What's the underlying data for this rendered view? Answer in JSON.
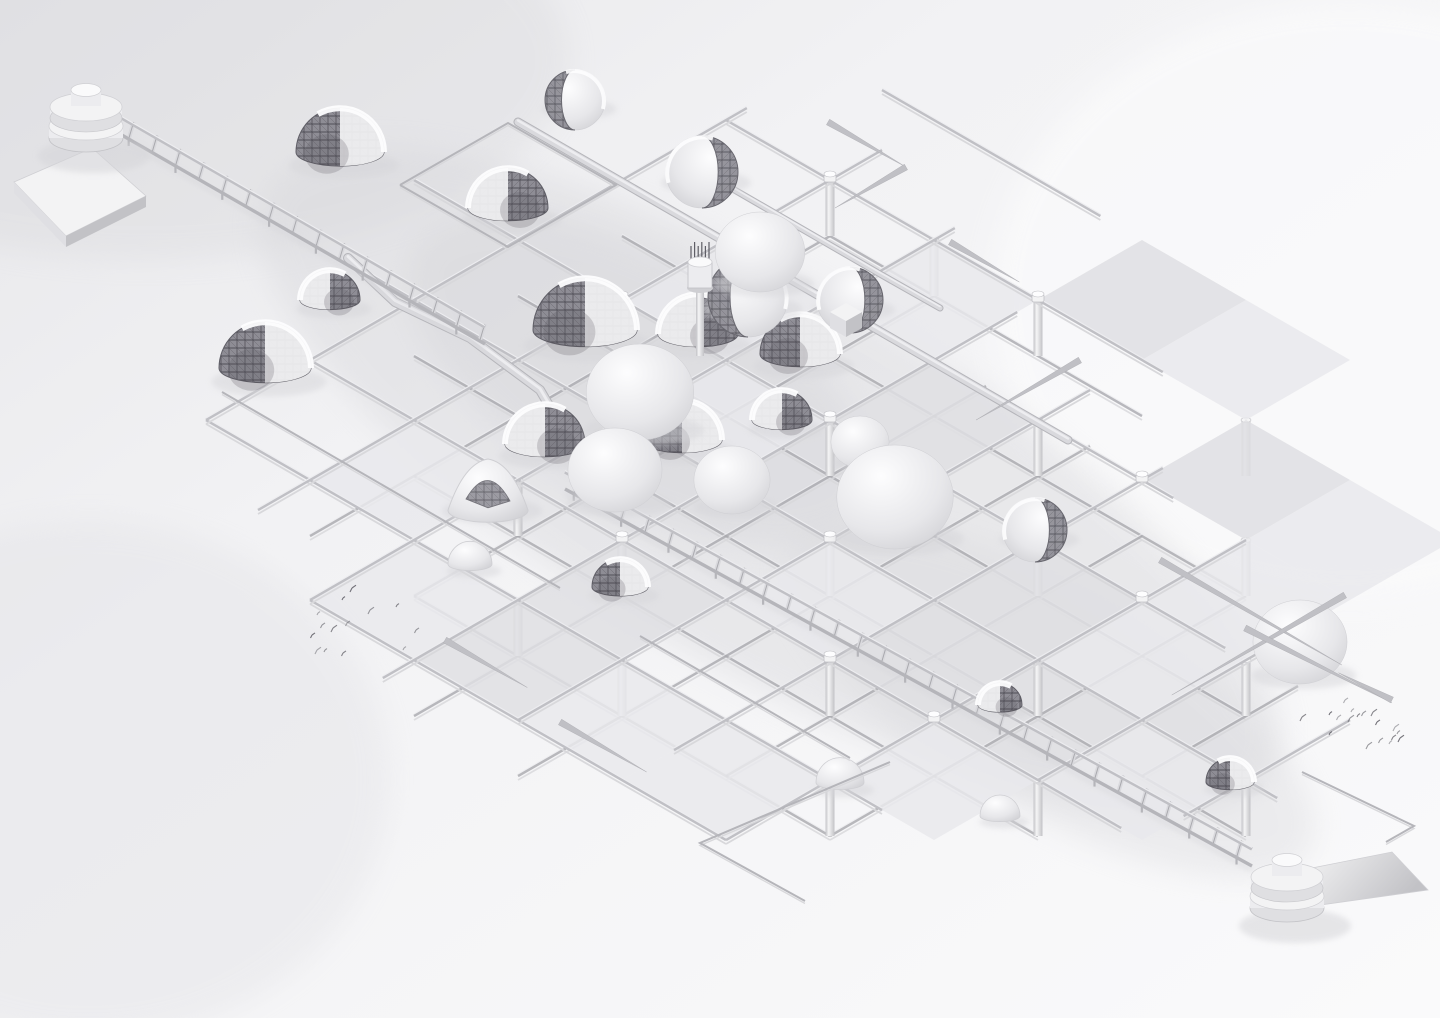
{
  "scene": {
    "title": "Monochrome isometric render of a modular space-frame structure with geodesic domes, conveyor trusses and spool terminals",
    "bg_base": "#f2f2f4",
    "bg_shade": "#e7e7ea",
    "bg_light": "#fafafb"
  },
  "palette": {
    "beam": "#c0c0c5",
    "beam_hi": "#ededf0",
    "beam_lo": "#d8d8db",
    "beam_dark": "#a9a9ae",
    "pipe": "#d9d9dd",
    "pipe_edge": "#b5b5ba",
    "panel": "#e9e9ec",
    "panel_dark": "#dfdfe3",
    "post_light": "#f5f5f6",
    "post_dark": "#c2c2c6",
    "mesh_base": "#8e8d95",
    "mesh_line": "#504f57",
    "mesh_edge": "#5f5e66",
    "shell_white": "#f3f3f4",
    "sphere_hi": "#fdfdfe",
    "sphere_mid": "#e7e7ea",
    "sphere_edge": "#cfcfd3",
    "shadow": "#d5d5d9",
    "speck": "#55545c",
    "spool_top": "#fafafb",
    "spool_body": "#ececef",
    "spool_rim": "#dfdfe2"
  },
  "grid": {
    "o": [
      830,
      60
    ],
    "u": [
      104,
      60
    ],
    "v": [
      -104,
      60
    ],
    "drop": 56,
    "railsU": [
      [
        0,
        0.5,
        2.6,
        0
      ],
      [
        1,
        0,
        4.2,
        0
      ],
      [
        2,
        -1,
        5.3,
        0
      ],
      [
        3,
        -1,
        6.8,
        0
      ],
      [
        4,
        -0.5,
        8.3,
        0
      ],
      [
        5,
        0,
        7.8,
        0
      ],
      [
        6,
        0,
        6.5,
        0
      ],
      [
        7,
        2,
        6,
        0
      ],
      [
        1,
        1,
        4,
        1
      ],
      [
        2,
        0,
        6,
        1
      ],
      [
        3,
        0,
        7,
        1
      ],
      [
        4,
        0,
        8,
        1
      ],
      [
        5,
        1,
        7,
        1
      ],
      [
        6,
        2,
        6,
        1
      ]
    ],
    "railsV": [
      [
        0,
        0.8,
        6,
        0
      ],
      [
        1,
        0.5,
        6.5,
        0
      ],
      [
        2,
        0.8,
        7,
        0
      ],
      [
        3,
        1.2,
        7.3,
        0
      ],
      [
        4,
        1.5,
        7,
        0
      ],
      [
        5,
        1.8,
        6.5,
        0
      ],
      [
        6,
        2,
        7,
        0
      ],
      [
        7,
        2.4,
        5,
        0
      ],
      [
        8,
        3,
        4.6,
        0
      ],
      [
        1,
        1,
        6,
        1
      ],
      [
        2,
        1,
        6,
        1
      ],
      [
        3,
        1.5,
        7,
        1
      ],
      [
        4,
        1.5,
        7,
        1
      ],
      [
        5,
        2,
        6,
        1
      ],
      [
        6,
        2,
        6,
        1
      ],
      [
        7,
        2.5,
        4,
        1
      ]
    ],
    "panels": [
      [
        3,
        0
      ],
      [
        4,
        0
      ],
      [
        2,
        1
      ],
      [
        5,
        1
      ],
      [
        6,
        1
      ],
      [
        1,
        2
      ],
      [
        3,
        2
      ],
      [
        6,
        2
      ],
      [
        2,
        3
      ],
      [
        5,
        3
      ],
      [
        6,
        3
      ],
      [
        4,
        4
      ],
      [
        5,
        4
      ],
      [
        7,
        4
      ],
      [
        1,
        5
      ],
      [
        3,
        5
      ],
      [
        6,
        5
      ],
      [
        2,
        6
      ],
      [
        3,
        6
      ],
      [
        4,
        6
      ],
      [
        5,
        6
      ]
    ],
    "posts": [
      [
        1,
        1
      ],
      [
        2,
        1
      ],
      [
        3,
        1
      ],
      [
        5,
        1
      ],
      [
        1,
        2
      ],
      [
        2,
        2
      ],
      [
        4,
        2
      ],
      [
        6,
        2
      ],
      [
        3,
        3
      ],
      [
        5,
        3
      ],
      [
        7,
        3
      ],
      [
        2,
        4
      ],
      [
        4,
        4
      ],
      [
        6,
        4
      ],
      [
        8,
        4
      ],
      [
        2,
        5
      ],
      [
        3,
        5
      ],
      [
        5,
        5
      ],
      [
        7,
        5
      ],
      [
        3,
        6
      ],
      [
        4,
        6
      ],
      [
        6,
        6
      ]
    ],
    "pucks": [
      [
        1,
        1
      ],
      [
        3,
        1
      ],
      [
        2,
        2
      ],
      [
        5,
        2
      ],
      [
        1,
        3
      ],
      [
        3,
        3
      ],
      [
        6,
        3
      ],
      [
        2,
        4
      ],
      [
        4,
        4
      ],
      [
        3,
        5
      ],
      [
        5,
        5
      ],
      [
        6,
        5
      ]
    ]
  },
  "pipes": [
    {
      "pts": [
        [
          518,
          122
        ],
        [
          826,
          300
        ],
        [
          1068,
          440
        ]
      ],
      "w": 7
    },
    {
      "pts": [
        [
          348,
          258
        ],
        [
          395,
          302
        ],
        [
          470,
          338
        ],
        [
          540,
          390
        ],
        [
          575,
          450
        ],
        [
          600,
          505
        ]
      ],
      "w": 8
    },
    {
      "pts": [
        [
          700,
          170
        ],
        [
          880,
          274
        ],
        [
          940,
          308
        ]
      ],
      "w": 5
    }
  ],
  "conveyors": [
    {
      "a": [
        120,
        130
      ],
      "b": [
        485,
        340
      ],
      "step": 27
    },
    {
      "a": [
        565,
        485
      ],
      "b": [
        1252,
        862
      ],
      "step": 27
    }
  ],
  "spools": [
    {
      "x": 86,
      "y": 112
    },
    {
      "x": 1287,
      "y": 882
    }
  ],
  "slab": [
    [
      14,
      182
    ],
    [
      92,
      148
    ],
    [
      146,
      196
    ],
    [
      66,
      236
    ]
  ],
  "wedge": [
    [
      1307,
      869
    ],
    [
      1392,
      852
    ],
    [
      1428,
      890
    ],
    [
      1313,
      906
    ]
  ],
  "turret": {
    "x": 700,
    "y": 278
  },
  "box": {
    "x": 846,
    "y": 312
  },
  "domes": [
    {
      "t": "dome",
      "x": 340,
      "y": 152,
      "r": 44
    },
    {
      "t": "dome",
      "x": 508,
      "y": 208,
      "r": 40
    },
    {
      "t": "dome",
      "x": 265,
      "y": 368,
      "r": 46
    },
    {
      "t": "dome",
      "x": 330,
      "y": 300,
      "r": 30
    },
    {
      "t": "dome",
      "x": 585,
      "y": 330,
      "r": 52
    },
    {
      "t": "dome",
      "x": 698,
      "y": 334,
      "r": 40
    },
    {
      "t": "dome",
      "x": 800,
      "y": 354,
      "r": 40
    },
    {
      "t": "dome",
      "x": 545,
      "y": 444,
      "r": 40
    },
    {
      "t": "dome",
      "x": 682,
      "y": 440,
      "r": 40
    },
    {
      "t": "dome",
      "x": 782,
      "y": 420,
      "r": 30
    },
    {
      "t": "dome",
      "x": 620,
      "y": 587,
      "r": 28
    },
    {
      "t": "dome",
      "x": 1000,
      "y": 705,
      "r": 22
    },
    {
      "t": "dome",
      "x": 1230,
      "y": 782,
      "r": 24
    },
    {
      "t": "sw",
      "x": 702,
      "y": 172,
      "r": 36
    },
    {
      "t": "sw",
      "x": 575,
      "y": 100,
      "r": 30
    },
    {
      "t": "sw",
      "x": 850,
      "y": 300,
      "r": 33
    },
    {
      "t": "sw",
      "x": 748,
      "y": 297,
      "r": 40
    },
    {
      "t": "sw",
      "x": 1035,
      "y": 530,
      "r": 32
    },
    {
      "t": "blob",
      "x": 640,
      "y": 392,
      "r": 48
    },
    {
      "t": "blob",
      "x": 615,
      "y": 470,
      "r": 42
    },
    {
      "t": "blob",
      "x": 732,
      "y": 480,
      "r": 34
    },
    {
      "t": "blob",
      "x": 860,
      "y": 442,
      "r": 26
    },
    {
      "t": "blob",
      "x": 895,
      "y": 497,
      "r": 52
    },
    {
      "t": "blob",
      "x": 1300,
      "y": 642,
      "r": 42
    },
    {
      "t": "blob",
      "x": 760,
      "y": 252,
      "r": 40
    },
    {
      "t": "cone",
      "x": 488,
      "y": 499,
      "r": 40
    },
    {
      "t": "smooth",
      "x": 840,
      "y": 778,
      "r": 24
    },
    {
      "t": "smooth",
      "x": 1000,
      "y": 812,
      "r": 20
    },
    {
      "t": "smooth",
      "x": 470,
      "y": 560,
      "r": 22
    }
  ],
  "spikes": [
    [
      828,
      122,
      30,
      90
    ],
    [
      906,
      167,
      150,
      82
    ],
    [
      1160,
      560,
      30,
      210
    ],
    [
      1345,
      595,
      150,
      200
    ],
    [
      1245,
      628,
      27,
      165
    ],
    [
      445,
      640,
      30,
      95
    ],
    [
      560,
      722,
      30,
      100
    ],
    [
      950,
      242,
      30,
      80
    ],
    [
      1080,
      360,
      150,
      120
    ],
    [
      1392,
      700,
      207,
      60
    ]
  ],
  "lines": [
    [
      [
        890,
        762
      ],
      [
        700,
        843
      ],
      [
        805,
        901
      ]
    ],
    [
      [
        1302,
        772
      ],
      [
        1414,
        826
      ],
      [
        1386,
        842
      ]
    ],
    [
      [
        400,
        185
      ],
      [
        508,
        123
      ],
      [
        616,
        185
      ],
      [
        508,
        247
      ],
      [
        400,
        185
      ]
    ],
    [
      [
        222,
        392
      ],
      [
        560,
        588
      ]
    ],
    [
      [
        640,
        636
      ],
      [
        850,
        758
      ]
    ]
  ],
  "flocks": [
    {
      "name": "left",
      "pts": [
        [
          318,
          613
        ],
        [
          322,
          625
        ],
        [
          333,
          628
        ],
        [
          343,
          598
        ],
        [
          347,
          623
        ],
        [
          370,
          610
        ],
        [
          397,
          605
        ],
        [
          312,
          635
        ],
        [
          317,
          650
        ],
        [
          325,
          650
        ],
        [
          343,
          653
        ],
        [
          352,
          588
        ],
        [
          404,
          648
        ],
        [
          416,
          630
        ]
      ]
    },
    {
      "name": "right",
      "pts": [
        [
          1352,
          710
        ],
        [
          1363,
          713
        ],
        [
          1373,
          712
        ],
        [
          1330,
          713
        ],
        [
          1338,
          717
        ],
        [
          1350,
          718
        ],
        [
          1358,
          715
        ],
        [
          1377,
          722
        ],
        [
          1395,
          727
        ],
        [
          1398,
          732
        ],
        [
          1393,
          737
        ],
        [
          1400,
          738
        ],
        [
          1390,
          742
        ],
        [
          1380,
          740
        ],
        [
          1302,
          717
        ],
        [
          1330,
          733
        ],
        [
          1345,
          700
        ],
        [
          1368,
          745
        ]
      ]
    }
  ]
}
